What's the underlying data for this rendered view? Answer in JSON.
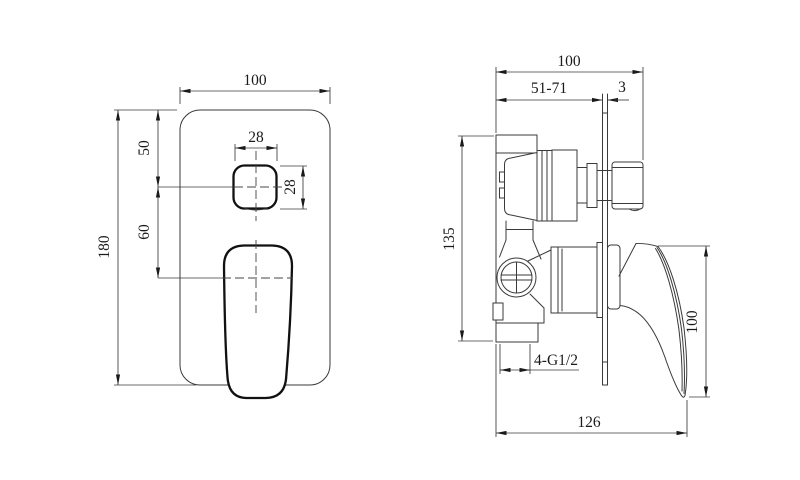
{
  "drawing": {
    "front_view": {
      "width": "100",
      "height": "180",
      "button_offset_top": "50",
      "handle_offset": "60",
      "button_width": "28",
      "button_height": "28"
    },
    "side_view": {
      "overall_depth": "100",
      "rough_in_range": "51-71",
      "plate_thickness": "3",
      "body_height": "135",
      "inlet_thread": "4-G1/2",
      "handle_height": "100",
      "overall_length": "126"
    },
    "colors": {
      "line": "#3a3a3a",
      "heavy_line": "#111111",
      "background": "#ffffff"
    }
  }
}
